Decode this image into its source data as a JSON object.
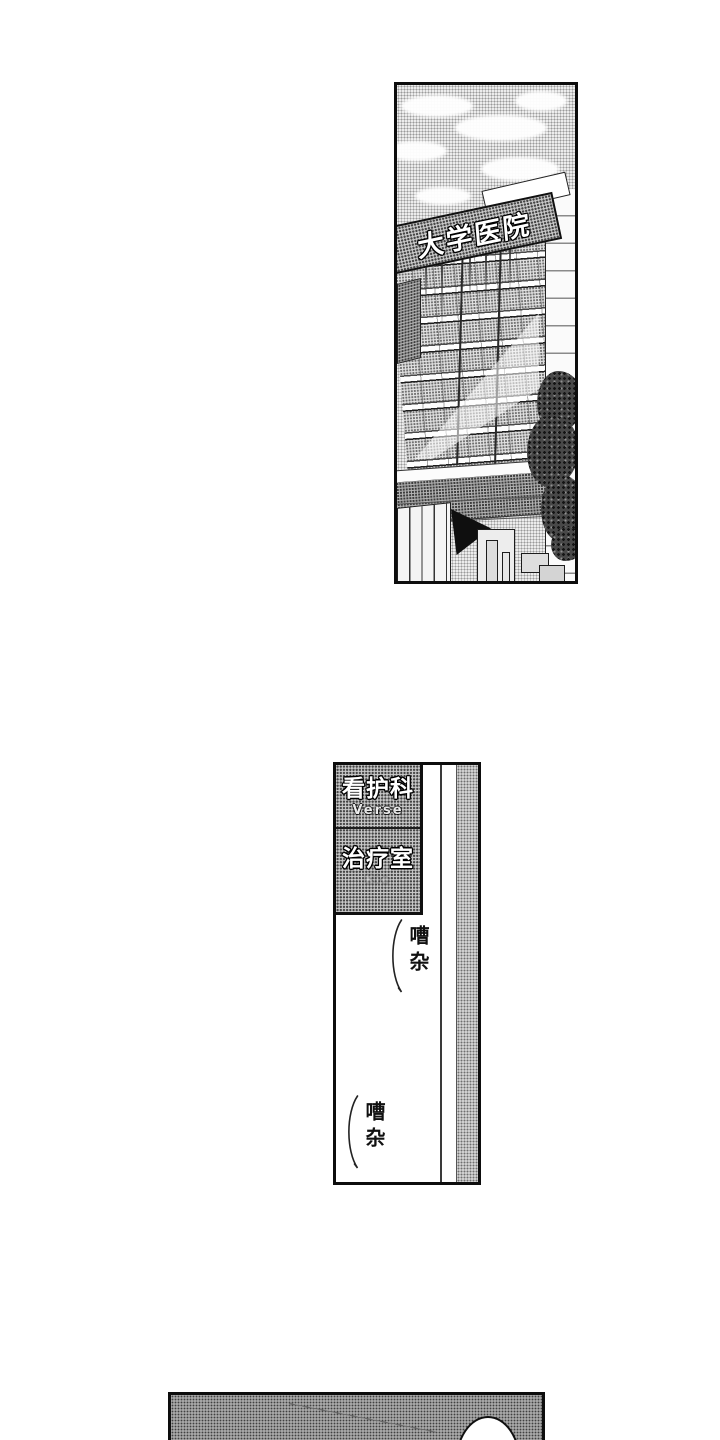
{
  "colors": {
    "ink": "#111111",
    "paper": "#ffffff",
    "halftone_dot": "#555555"
  },
  "hospital_panel": {
    "sign_text": "大学医院"
  },
  "corridor_panel": {
    "nursing_sign": {
      "title": "看护科",
      "subtitle": "Verse"
    },
    "treatment_sign": {
      "title": "治疗室",
      "subtitle": "Kie"
    },
    "sfx_noise_top": "嘈杂",
    "sfx_noise_bottom": "嘈杂"
  }
}
